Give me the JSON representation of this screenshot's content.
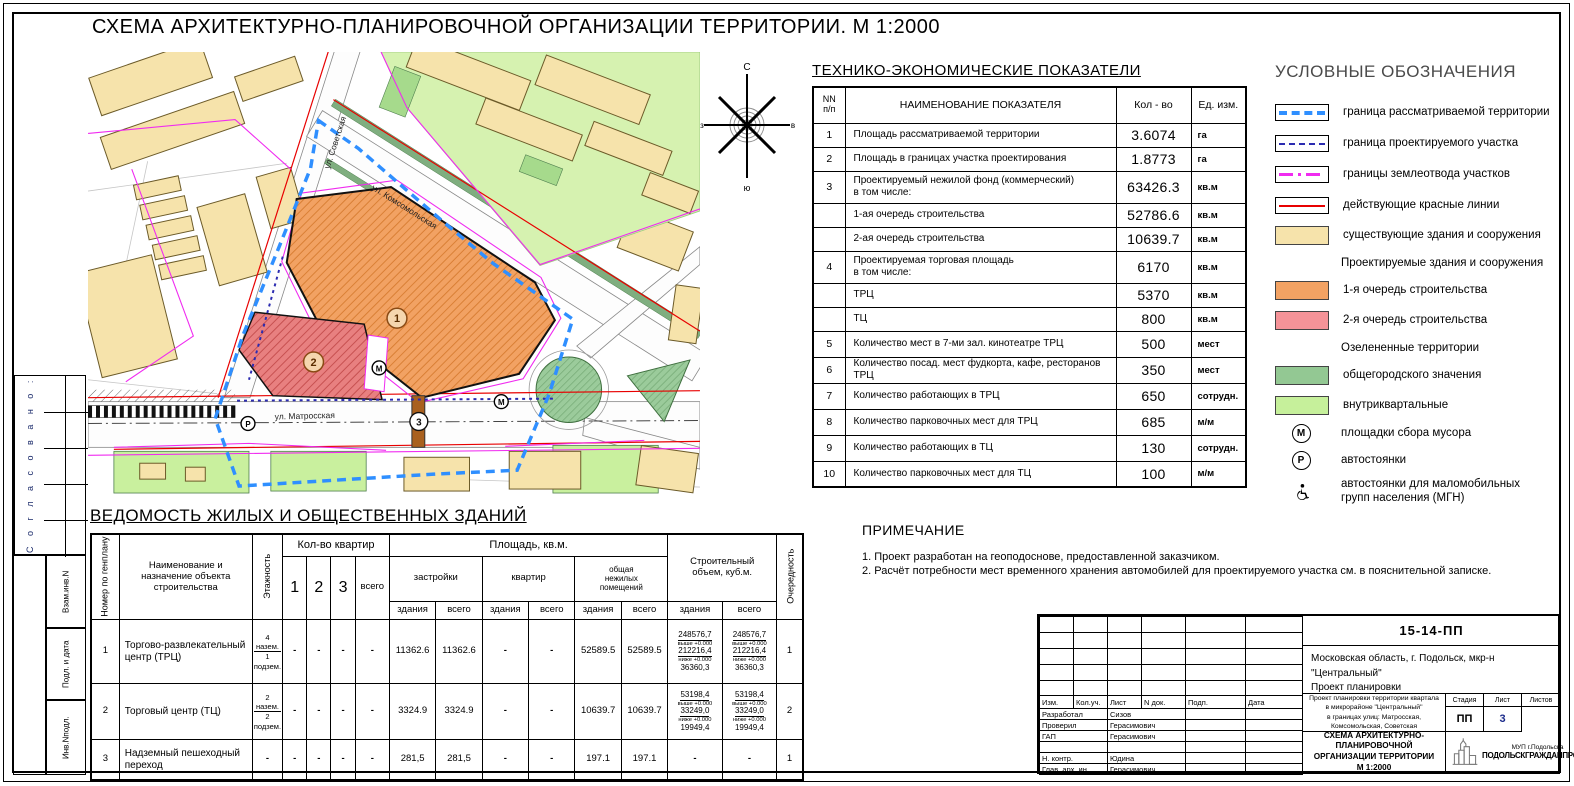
{
  "sheet": {
    "title": "СХЕМА АРХИТЕКТУРНО-ПЛАНИРОВОЧНОЙ ОРГАНИЗАЦИИ ТЕРРИТОРИИ. М 1:2000"
  },
  "map": {
    "streets": {
      "sovetskaya": "ул. Советская",
      "komsomolskaya": "ул. Комсомольская",
      "matrosskaya": "ул. Матросская"
    },
    "markers": {
      "stage1": "1",
      "stage2": "2",
      "bridge": "3",
      "waste": "М",
      "parking": "Р"
    },
    "compass": {
      "north": "С",
      "south": "ю",
      "east": "в",
      "west": "з"
    }
  },
  "tep": {
    "title": "ТЕХНИКО-ЭКОНОМИЧЕСКИЕ ПОКАЗАТЕЛИ",
    "headers": {
      "num": "NN\nп/п",
      "name": "НАИМЕНОВАНИЕ ПОКАЗАТЕЛЯ",
      "qty": "Кол - во",
      "unit": "Ед. изм."
    },
    "rows": [
      {
        "num": "1",
        "name": "Площадь рассматриваемой территории",
        "qty": "3.6074",
        "unit": "га"
      },
      {
        "num": "2",
        "name": "Площадь в границах участка проектирования",
        "qty": "1.8773",
        "unit": "га"
      },
      {
        "num": "3",
        "name": "Проектируемый нежилой фонд (коммерческий)\nв том числе:",
        "qty": "63426.3",
        "unit": "кв.м"
      },
      {
        "num": "",
        "name": "1-ая очередь строительства",
        "qty": "52786.6",
        "unit": "кв.м"
      },
      {
        "num": "",
        "name": "2-ая очередь строительства",
        "qty": "10639.7",
        "unit": "кв.м"
      },
      {
        "num": "4",
        "name": "Проектируемая торговая площадь\nв том числе:",
        "qty": "6170",
        "unit": "кв.м"
      },
      {
        "num": "",
        "name": "ТРЦ",
        "qty": "5370",
        "unit": "кв.м"
      },
      {
        "num": "",
        "name": "ТЦ",
        "qty": "800",
        "unit": "кв.м"
      },
      {
        "num": "5",
        "name": "Количество мест в 7-ми зал. кинотеатре ТРЦ",
        "qty": "500",
        "unit": "мест"
      },
      {
        "num": "6",
        "name": "Количество посад. мест фудкорта, кафе, ресторанов ТРЦ",
        "qty": "350",
        "unit": "мест"
      },
      {
        "num": "7",
        "name": "Количество работающих в ТРЦ",
        "qty": "650",
        "unit": "сотрудн."
      },
      {
        "num": "8",
        "name": "Количество парковочных мест для ТРЦ",
        "qty": "685",
        "unit": "м/м"
      },
      {
        "num": "9",
        "name": "Количество работающих в ТЦ",
        "qty": "130",
        "unit": "сотрудн."
      },
      {
        "num": "10",
        "name": "Количество парковочных мест для ТЦ",
        "qty": "100",
        "unit": "м/м"
      }
    ]
  },
  "legend": {
    "title": "УСЛОВНЫЕ ОБОЗНАЧЕНИЯ",
    "items": [
      {
        "label": "граница рассматриваемой территории"
      },
      {
        "label": "граница проектируемого участка"
      },
      {
        "label": "границы землеотвода участков"
      },
      {
        "label": "действующие красные линии"
      },
      {
        "label": "существующие здания и сооружения"
      },
      {
        "label": "Проектируемые здания и сооружения"
      },
      {
        "label": "1-я очередь строительства"
      },
      {
        "label": "2-я очередь строительства"
      },
      {
        "label": "Озелененные территории"
      },
      {
        "label": "общегородского значения"
      },
      {
        "label": "внутриквартальные"
      },
      {
        "label": "площадки сбора мусора",
        "symbol": "М"
      },
      {
        "label": "автостоянки",
        "symbol": "Р"
      },
      {
        "label": "автостоянки для маломобильных\nгрупп населения (МГН)"
      }
    ]
  },
  "note": {
    "title": "ПРИМЕЧАНИЕ",
    "lines": [
      "1. Проект разработан на геоподоснове, предоставленной заказчиком.",
      "2. Расчёт потребности мест временного хранения автомобилей для проектируемого участка см. в пояснительной записке."
    ]
  },
  "vedomost": {
    "title": "ВЕДОМОСТЬ  ЖИЛЫХ И ОБЩЕСТВЕННЫХ ЗДАНИЙ",
    "headers": {
      "col_num": "Номер по генплану",
      "col_name": "Наименование и\nназначение объекта\nстроительства",
      "col_floors": "Этажность",
      "grp_flats": "Кол-во квартир",
      "f1": "1",
      "f2": "2",
      "f3": "3",
      "f_total": "всего",
      "grp_area": "Площадь, кв.м.",
      "sub_zastr": "застройки",
      "sub_kvartir": "квартир",
      "sub_nezhil": "общая\nнежилых\nпомещений",
      "sub_bld": "здания",
      "sub_total": "всего",
      "grp_vol": "Строительный\nобъем, куб.м.",
      "col_ocher": "Очередность"
    },
    "rows": [
      {
        "num": "1",
        "name": "Торгово-развлекательный центр (ТРЦ)",
        "ft": "4 назем.",
        "fb": "1 подзем.",
        "dash": "-",
        "zb": "11362.6",
        "zt": "11362.6",
        "nb": "52589.5",
        "nt": "52589.5",
        "vol": {
          "v1": "248576,7",
          "l1": "выше +0.000",
          "v2": "212216,4",
          "l2": "ниже +0.000",
          "v3": "36360,3"
        },
        "och": "1"
      },
      {
        "num": "2",
        "name": "Торговый центр (ТЦ)",
        "ft": "2 назем.",
        "fb": "2 подзем.",
        "dash": "-",
        "zb": "3324.9",
        "zt": "3324.9",
        "nb": "10639.7",
        "nt": "10639.7",
        "vol": {
          "v1": "53198,4",
          "l1": "выше +0.000",
          "v2": "33249,0",
          "l2": "ниже +0.000",
          "v3": "19949,4"
        },
        "och": "2"
      },
      {
        "num": "3",
        "name": "Надземный пешеходный переход",
        "dash": "-",
        "zb": "281,5",
        "zt": "281,5",
        "nb": "197.1",
        "nt": "197.1",
        "och": "1"
      }
    ]
  },
  "stamp": {
    "doc_number": "15-14-ПП",
    "loc1": "Московская область, г. Подольск, мкр-н \"Центральный\"",
    "loc2": "Проект планировки",
    "cols": {
      "izm": "Изм.",
      "koluch": "Кол.уч.",
      "list": "Лист",
      "ndok": "N док.",
      "podp": "Подп.",
      "date": "Дата"
    },
    "roles": [
      {
        "role": "Разработал",
        "name": "Сизов"
      },
      {
        "role": "Проверил",
        "name": "Герасимович"
      },
      {
        "role": "ГАП",
        "name": "Герасимович"
      },
      {
        "role": "",
        "name": ""
      },
      {
        "role": "Н. контр.",
        "name": "Юдина"
      },
      {
        "role": "Глав. арх. ин.",
        "name": "Герасимович"
      }
    ],
    "project_desc": "Проект планировки территории квартала\nв микрорайоне \"Центральный\"\nв границах улиц: Матросская, Комсомольская, Советская",
    "sheet_name": "СХЕМА АРХИТЕКТУРНО-ПЛАНИРОВОЧНОЙ\nОРГАНИЗАЦИИ ТЕРРИТОРИИ\nМ 1:2000",
    "stage_label": "Стадия",
    "list_label": "Лист",
    "listov_label": "Листов",
    "stage": "ПП",
    "sheet_no": "3",
    "sheets_total": "",
    "org1": "МУП г.Подольска",
    "org2": "ПОДОЛЬСКГРАЖДАНПРОЕКТ"
  },
  "sidebar": {
    "agreed": "С о г л а с о в а н о :",
    "vzam": "Взам.инв.N",
    "podl": "Подл. и дата",
    "inv": "Инв.Nподл."
  },
  "colors": {
    "first_stage": "#F2A263",
    "second_stage": "#F59398",
    "existing": "#F6E3AB",
    "green_city": "#93C893",
    "green_local": "#C6F09B",
    "boundary_blue": "#2F8FFF",
    "plot_blue": "#2B2BB0",
    "landplot_magenta": "#F02BF0",
    "red_line": "#E80000"
  }
}
